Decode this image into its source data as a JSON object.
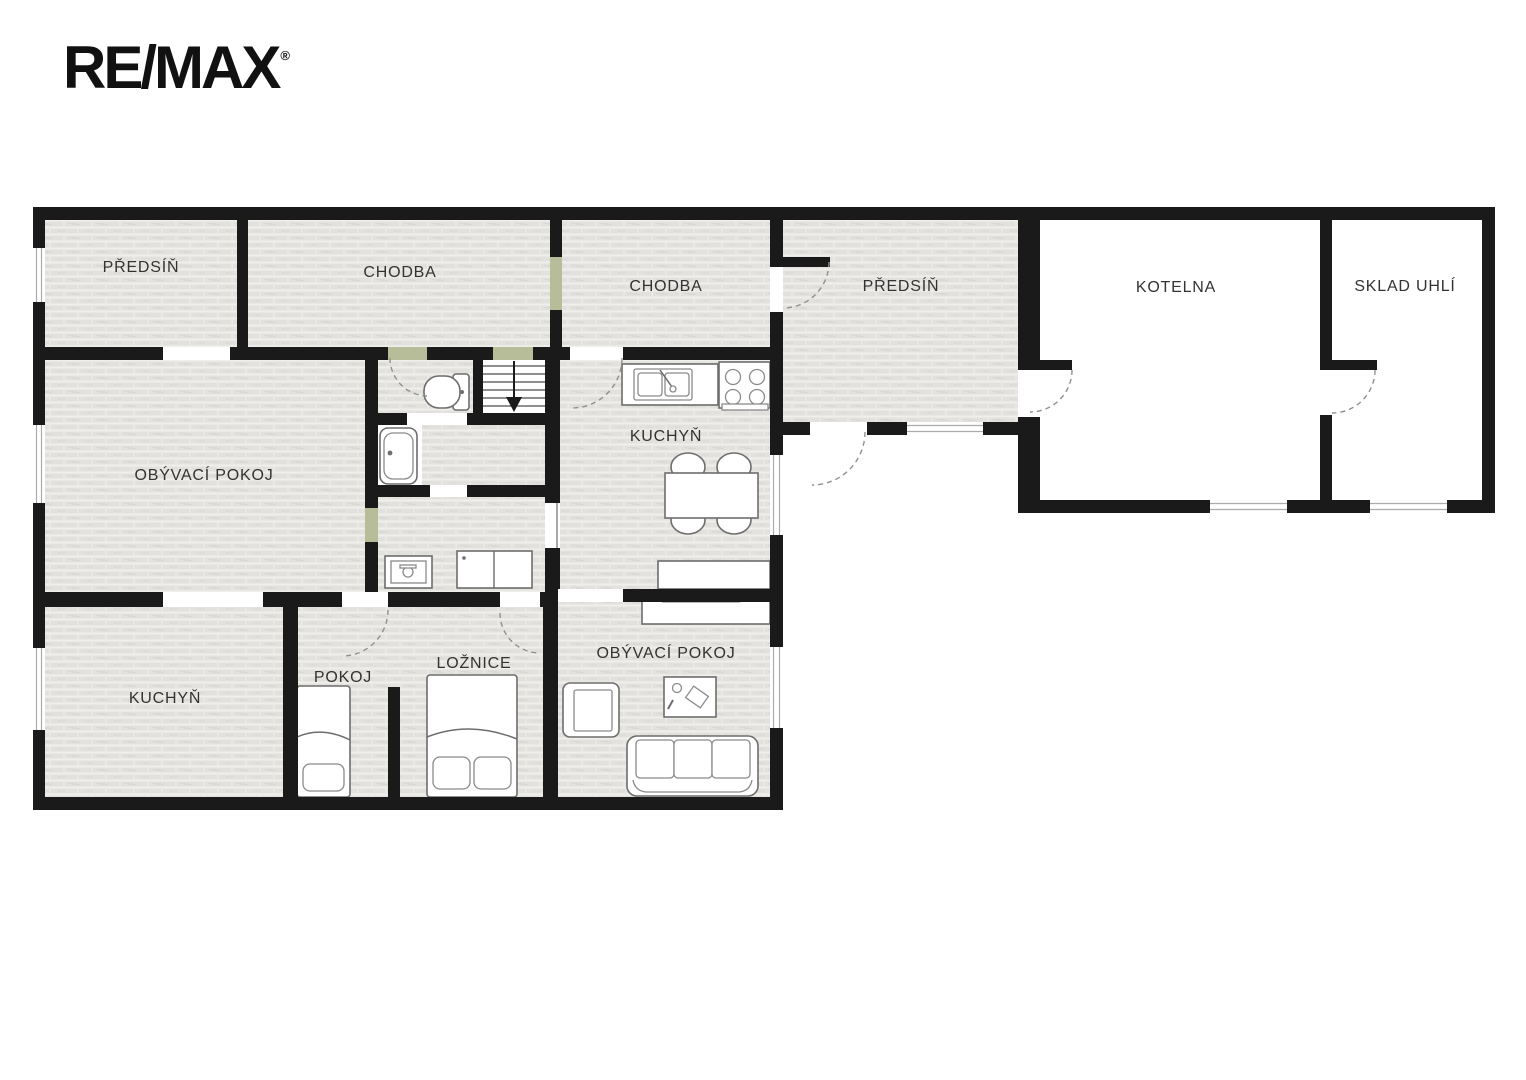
{
  "logo": {
    "brand": "RE/MAX",
    "registered": "®"
  },
  "plan": {
    "type": "floor-plan",
    "rooms": [
      {
        "id": "predsin-1",
        "label": "PŘEDSÍŇ"
      },
      {
        "id": "chodba-1",
        "label": "CHODBA"
      },
      {
        "id": "chodba-2",
        "label": "CHODBA"
      },
      {
        "id": "predsin-2",
        "label": "PŘEDSÍŇ"
      },
      {
        "id": "kotelna",
        "label": "KOTELNA"
      },
      {
        "id": "sklad-uhli",
        "label": "SKLAD UHLÍ"
      },
      {
        "id": "obyvaci-pokoj-1",
        "label": "OBÝVACÍ POKOJ"
      },
      {
        "id": "kuchyn-1",
        "label": "KUCHYŇ"
      },
      {
        "id": "kuchyn-2",
        "label": "KUCHYŇ"
      },
      {
        "id": "pokoj",
        "label": "POKOJ"
      },
      {
        "id": "loznice",
        "label": "LOŽNICE"
      },
      {
        "id": "obyvaci-pokoj-2",
        "label": "OBÝVACÍ POKOJ"
      }
    ],
    "colors": {
      "wall": "#1a1a1a",
      "room_fill": "#e2e1de",
      "door_accent": "#b7bd99",
      "furniture_outline": "#6d6d6d",
      "label_text": "#333333"
    }
  }
}
